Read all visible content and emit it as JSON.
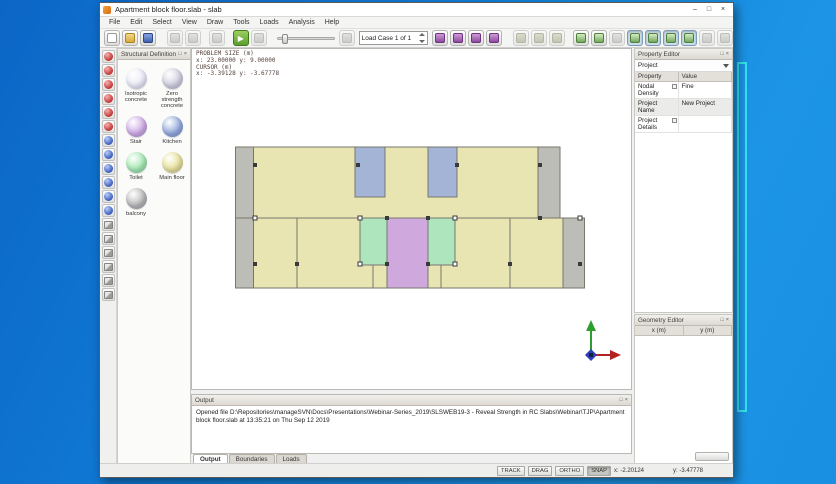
{
  "window": {
    "title": "Apartment block floor.slab - slab",
    "controls": {
      "minimize": "–",
      "maximize": "□",
      "close": "×"
    }
  },
  "menu": {
    "items": [
      "File",
      "Edit",
      "Select",
      "View",
      "Draw",
      "Tools",
      "Loads",
      "Analysis",
      "Help"
    ]
  },
  "toolbar": {
    "load_case": "Load Case 1 of 1",
    "play_glyph": "▶"
  },
  "canvas_info": {
    "line1": "PROBLEM SIZE (m)",
    "line2": "x: 23.00000 y: 9.00000",
    "line3": "CURSOR (m)",
    "line4": "x: -3.39128 y: -3.67778"
  },
  "structural": {
    "title": "Structural Definitions",
    "items": [
      {
        "label": "Isotropic concrete",
        "color": "#eaeaf6"
      },
      {
        "label": "Zero strength concrete",
        "color": "#cfcedd"
      },
      {
        "label": "Stair",
        "color": "#cba6e3"
      },
      {
        "label": "Kitchen",
        "color": "#8ea6d9"
      },
      {
        "label": "Toilet",
        "color": "#9fe8ac"
      },
      {
        "label": "Main floor",
        "color": "#e7e094"
      },
      {
        "label": "balcony",
        "color": "#b4b4b4"
      }
    ]
  },
  "property_editor": {
    "title": "Property Editor",
    "selector": "Project",
    "col_property": "Property",
    "col_value": "Value",
    "rows": [
      {
        "name": "Nodal Density",
        "value": "Fine"
      },
      {
        "name": "Project Name",
        "value": "New Project"
      },
      {
        "name": "Project Details",
        "value": ""
      }
    ]
  },
  "geometry_editor": {
    "title": "Geometry Editor",
    "col_x": "x (m)",
    "col_y": "y (m)"
  },
  "output": {
    "title": "Output",
    "message": "Opened file D:\\Repositories\\manageSVN\\Docs\\Presentations\\Webinar-Series_2019\\SLSWEB19-3 - Reveal Strength in RC Slabs\\Webinar\\TJP\\Apartment block floor.slab at 13:35:21 on Thu Sep 12 2019"
  },
  "tabs": {
    "items": [
      "Output",
      "Boundaries",
      "Loads"
    ],
    "active": "Output"
  },
  "status": {
    "toggles": [
      "TRACK",
      "DRAG",
      "ORTHO",
      "SNAP"
    ],
    "active_toggle": "SNAP",
    "coord_x": "x: -2.20124",
    "coord_y": "y: -3.47778"
  },
  "plan": {
    "problem_size": {
      "x_m": 23,
      "y_m": 9
    },
    "colors": {
      "floor": "#e9e5b3",
      "balcony": "#bdbdb8",
      "kitchen": "#a3b4d7",
      "toilet": "#aee5bd",
      "stair": "#cfa8dd",
      "outline": "#77776e",
      "column": "#3a3a3a"
    },
    "accent_cyan": "#35e3e9",
    "desktop_blue": "#1180d8"
  }
}
